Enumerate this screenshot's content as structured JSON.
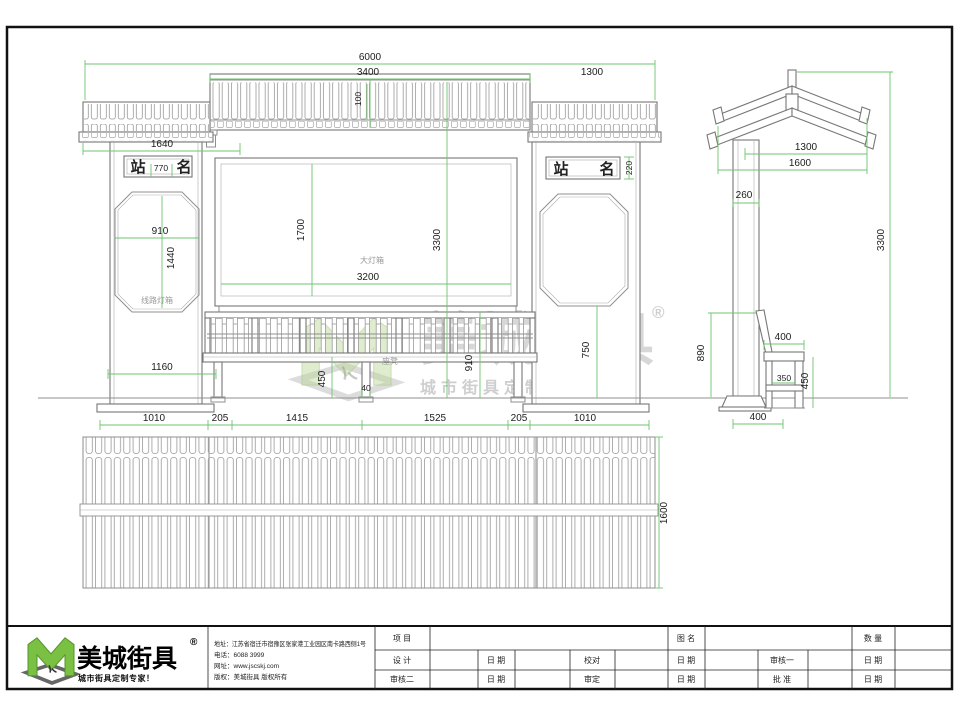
{
  "front": {
    "dims": {
      "total_w": "6000",
      "roof_center": "3400",
      "roof_right": "1300",
      "roof_left": "1640",
      "sign_left": "770",
      "sign_right": "220",
      "gap": "100",
      "panel_w": "910",
      "panel_h": "1440",
      "box_h": "1700",
      "total_h": "3300",
      "box_w": "3200",
      "panel_bottom": "750",
      "bench_h": "910",
      "seat_h": "450",
      "leg": "40",
      "pillar_w": "1160",
      "base1": "1010",
      "base2": "205",
      "base3": "1415",
      "base4": "1525",
      "base5": "205",
      "base6": "1010"
    },
    "labels": {
      "station_l": "站",
      "station_r": "名",
      "lightbox": "大灯箱",
      "route_box": "线路灯箱",
      "bench": "座凳"
    }
  },
  "side": {
    "dims": {
      "roof_upper": "1300",
      "roof_total": "1600",
      "column": "260",
      "total_h": "3300",
      "back_h": "890",
      "seat_depth": "400",
      "seat_inner": "350",
      "seat_h": "450",
      "base": "400"
    }
  },
  "plan": {
    "dims": {
      "depth": "1600"
    }
  },
  "watermark": {
    "brand": "美城街具",
    "reg": "®",
    "tagline": "城市街具定制专家！"
  },
  "title_block": {
    "logo": {
      "brand": "美城街具",
      "reg": "®",
      "tagline": "城市街具定制专家！"
    },
    "contact": {
      "address": "地址：江苏省宿迁市宿豫区张家港工业园区南卡路西侧1号",
      "phone": "电话：6088 3999",
      "website": "网址：www.jscskj.com",
      "copyright": "版权：美城街具 版权所有"
    },
    "fields": {
      "project": "项 目",
      "design": "设 计",
      "reviewer2": "审核二",
      "date": "日 期",
      "proofread": "校对",
      "verify": "审定",
      "drawing_name": "图 名",
      "reviewer1": "审核一",
      "approve": "批 准",
      "quantity": "数 量"
    }
  }
}
